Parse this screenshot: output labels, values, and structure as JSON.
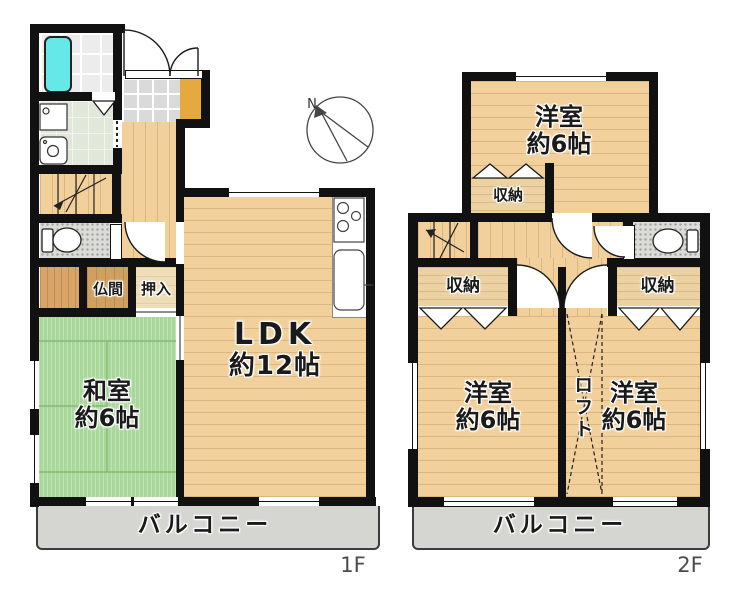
{
  "compass": {
    "north_label": "N"
  },
  "floor1": {
    "label": "1F",
    "rooms": {
      "ldk": {
        "name": "LDK",
        "size": "約12帖"
      },
      "washitsu": {
        "name": "和室",
        "size": "約6帖"
      },
      "butsuma": {
        "label": "仏間"
      },
      "oshiire": {
        "label": "押入"
      }
    },
    "balcony": {
      "label": "バルコニー"
    }
  },
  "floor2": {
    "label": "2F",
    "rooms": {
      "bedroom_top": {
        "name": "洋室",
        "size": "約6帖"
      },
      "bedroom_left": {
        "name": "洋室",
        "size": "約6帖"
      },
      "bedroom_right": {
        "name": "洋室",
        "size": "約6帖"
      }
    },
    "closets": {
      "top": {
        "label": "収納"
      },
      "left": {
        "label": "収納"
      },
      "right": {
        "label": "収納"
      }
    },
    "loft": {
      "label": "ロフト"
    },
    "balcony": {
      "label": "バルコニー"
    }
  },
  "colors": {
    "wall": "#111111",
    "wood": "#f1d09c",
    "tatami": "#a8d79a",
    "balcony": "#d5d6d1",
    "tile": "#dadada",
    "bath_tile": "#ececec",
    "washroom": "#e2e8d9",
    "closet_tan": "#ecd2a2",
    "oshiire": "#efddb8",
    "butsuma": "#cfa05f",
    "wood_dark": "#d8a468",
    "shoe_cabinet": "#e5a93e",
    "bathtub": "#66e8e9",
    "toilet_floor": "#dbdbd7",
    "label": "#1a1a1a",
    "floor_label": "#4b4b4b"
  }
}
